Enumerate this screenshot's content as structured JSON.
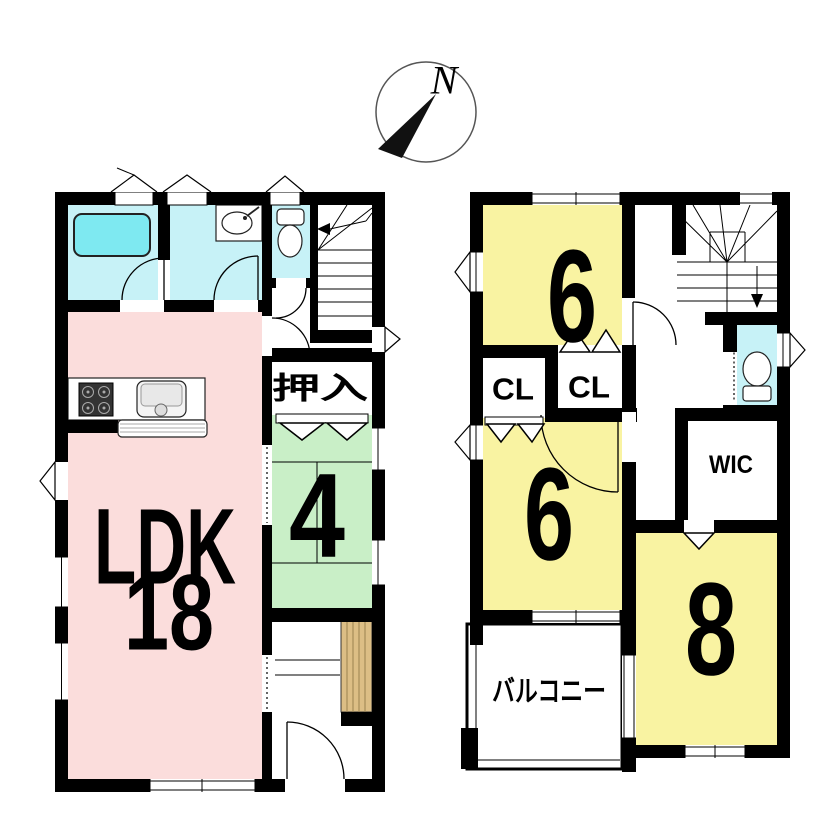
{
  "compass": {
    "north_label": "N"
  },
  "colors": {
    "wall": "#000000",
    "ldk_pink": "#FBDDDC",
    "room_yellow": "#F9F3A2",
    "tatami_green": "#C9EFC7",
    "water_cyan": "#C7F2F7",
    "tub_cyan": "#7EE9F1",
    "wood": "#DCBE85"
  },
  "floor1": {
    "ldk_label": "LDK",
    "ldk_size": "18",
    "tatami_size": "4",
    "oshiire_label": "押入"
  },
  "floor2": {
    "bedroom_top_size": "6",
    "bedroom_mid_size": "6",
    "bedroom_large_size": "8",
    "closet1_label": "CL",
    "closet2_label": "CL",
    "wic_label": "WIC",
    "balcony_label": "バルコニー"
  }
}
